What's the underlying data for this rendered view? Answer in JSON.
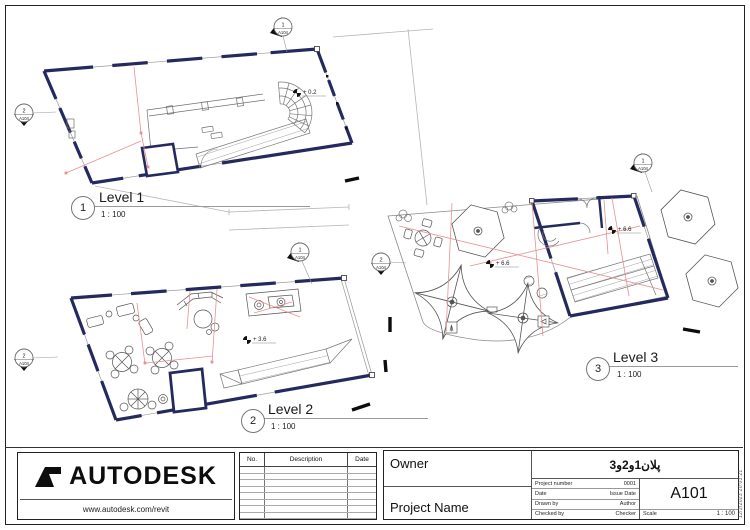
{
  "sheet": {
    "views": [
      {
        "bubble": "1",
        "title": "Level 1",
        "scale": "1 : 100"
      },
      {
        "bubble": "2",
        "title": "Level 2",
        "scale": "1 : 100"
      },
      {
        "bubble": "3",
        "title": "Level 3",
        "scale": "1 : 100"
      }
    ],
    "spot_elevations": [
      "+ 0.2",
      "+ 3.6",
      "+ 6.6",
      "+ 6.6"
    ],
    "elevation_markers": [
      {
        "number": "1",
        "sheet": "A104"
      },
      {
        "number": "2",
        "sheet": "A104"
      },
      {
        "number": "1",
        "sheet": "A104"
      },
      {
        "number": "2",
        "sheet": "A104"
      },
      {
        "number": "2",
        "sheet": "A104"
      },
      {
        "number": "1",
        "sheet": "A104"
      }
    ]
  },
  "title_block": {
    "logo": {
      "brand": "AUTODESK",
      "url": "www.autodesk.com/revit"
    },
    "revisions": {
      "col_no": "No.",
      "col_description": "Description",
      "col_date": "Date"
    },
    "owner_label": "Owner",
    "project_title": "پلان1و2و3",
    "project_name_label": "Project Name",
    "project_number_label": "Project number",
    "project_number": "0001",
    "date_label": "Date",
    "date_value": "Issue Date",
    "drawn_by_label": "Drawn by",
    "drawn_by": "Author",
    "checked_by_label": "Checked by",
    "checked_by": "Checker",
    "sheet_number": "A101",
    "scale_label": "Scale",
    "scale_value": "1 : 100",
    "print_stamp": "12/2/2023 20:03:21"
  },
  "colors": {
    "wall": "#252a5e",
    "annotation_red": "#e89090",
    "line_gray": "#8a8a8a"
  }
}
